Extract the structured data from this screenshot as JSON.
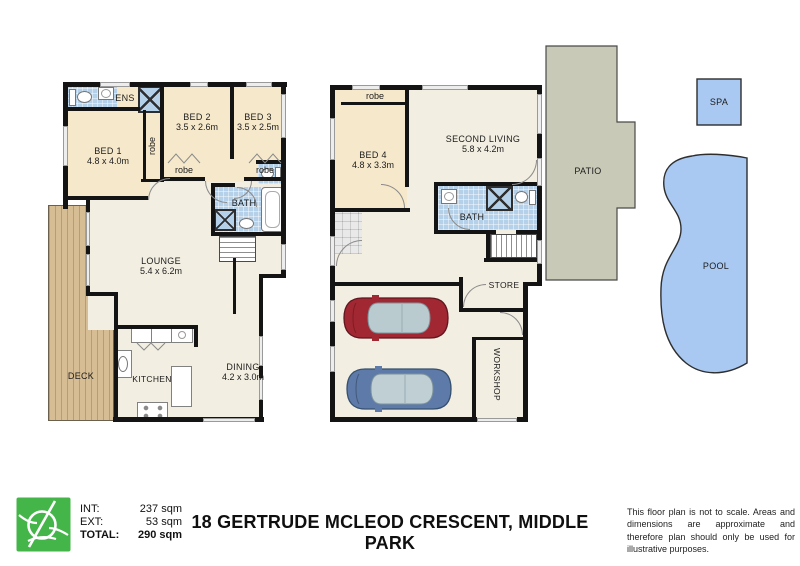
{
  "level1": {
    "ens": "ENS",
    "robe_wall": "robe",
    "bed1": {
      "name": "BED 1",
      "dims": "4.8 x 4.0m"
    },
    "bed2": {
      "name": "BED 2",
      "dims": "3.5 x 2.6m"
    },
    "bed3": {
      "name": "BED 3",
      "dims": "3.5 x 2.5m"
    },
    "robe2": "robe",
    "robe3": "robe",
    "bath": "BATH",
    "lounge": {
      "name": "LOUNGE",
      "dims": "5.4 x 6.2m"
    },
    "deck": "DECK",
    "kitchen": "KITCHEN",
    "dining": {
      "name": "DINING",
      "dims": "4.2 x 3.0m"
    }
  },
  "ground": {
    "robe4": "robe",
    "bed4": {
      "name": "BED 4",
      "dims": "4.8 x 3.3m"
    },
    "second_living": {
      "name": "SECOND LIVING",
      "dims": "5.8 x 4.2m"
    },
    "bath": "BATH",
    "store": "STORE",
    "workshop": "WORKSHOP"
  },
  "outdoor": {
    "patio": "PATIO",
    "spa": "SPA",
    "pool": "POOL"
  },
  "footer": {
    "areas": [
      {
        "label": "INT:",
        "value": "237 sqm"
      },
      {
        "label": "EXT:",
        "value": "53 sqm"
      },
      {
        "label": "TOTAL:",
        "value": "290 sqm"
      }
    ],
    "address": "18 GERTRUDE MCLEOD CRESCENT, MIDDLE PARK",
    "disclaimer": "This floor plan is not to scale. Areas and dimensions are approximate and therefore plan should only be used for illustrative purposes."
  },
  "colors": {
    "wall": "#141414",
    "floor": "#f2eee1",
    "bedroom_floor": "#f6e8cb",
    "tile_blue": "#b5d0e9",
    "deck": "#d7bd94",
    "patio": "#c9c9b7",
    "water": "#a9c9f2",
    "car_red": "#a12833",
    "car_blue": "#5d7aa8",
    "logo_green": "#44b549"
  }
}
